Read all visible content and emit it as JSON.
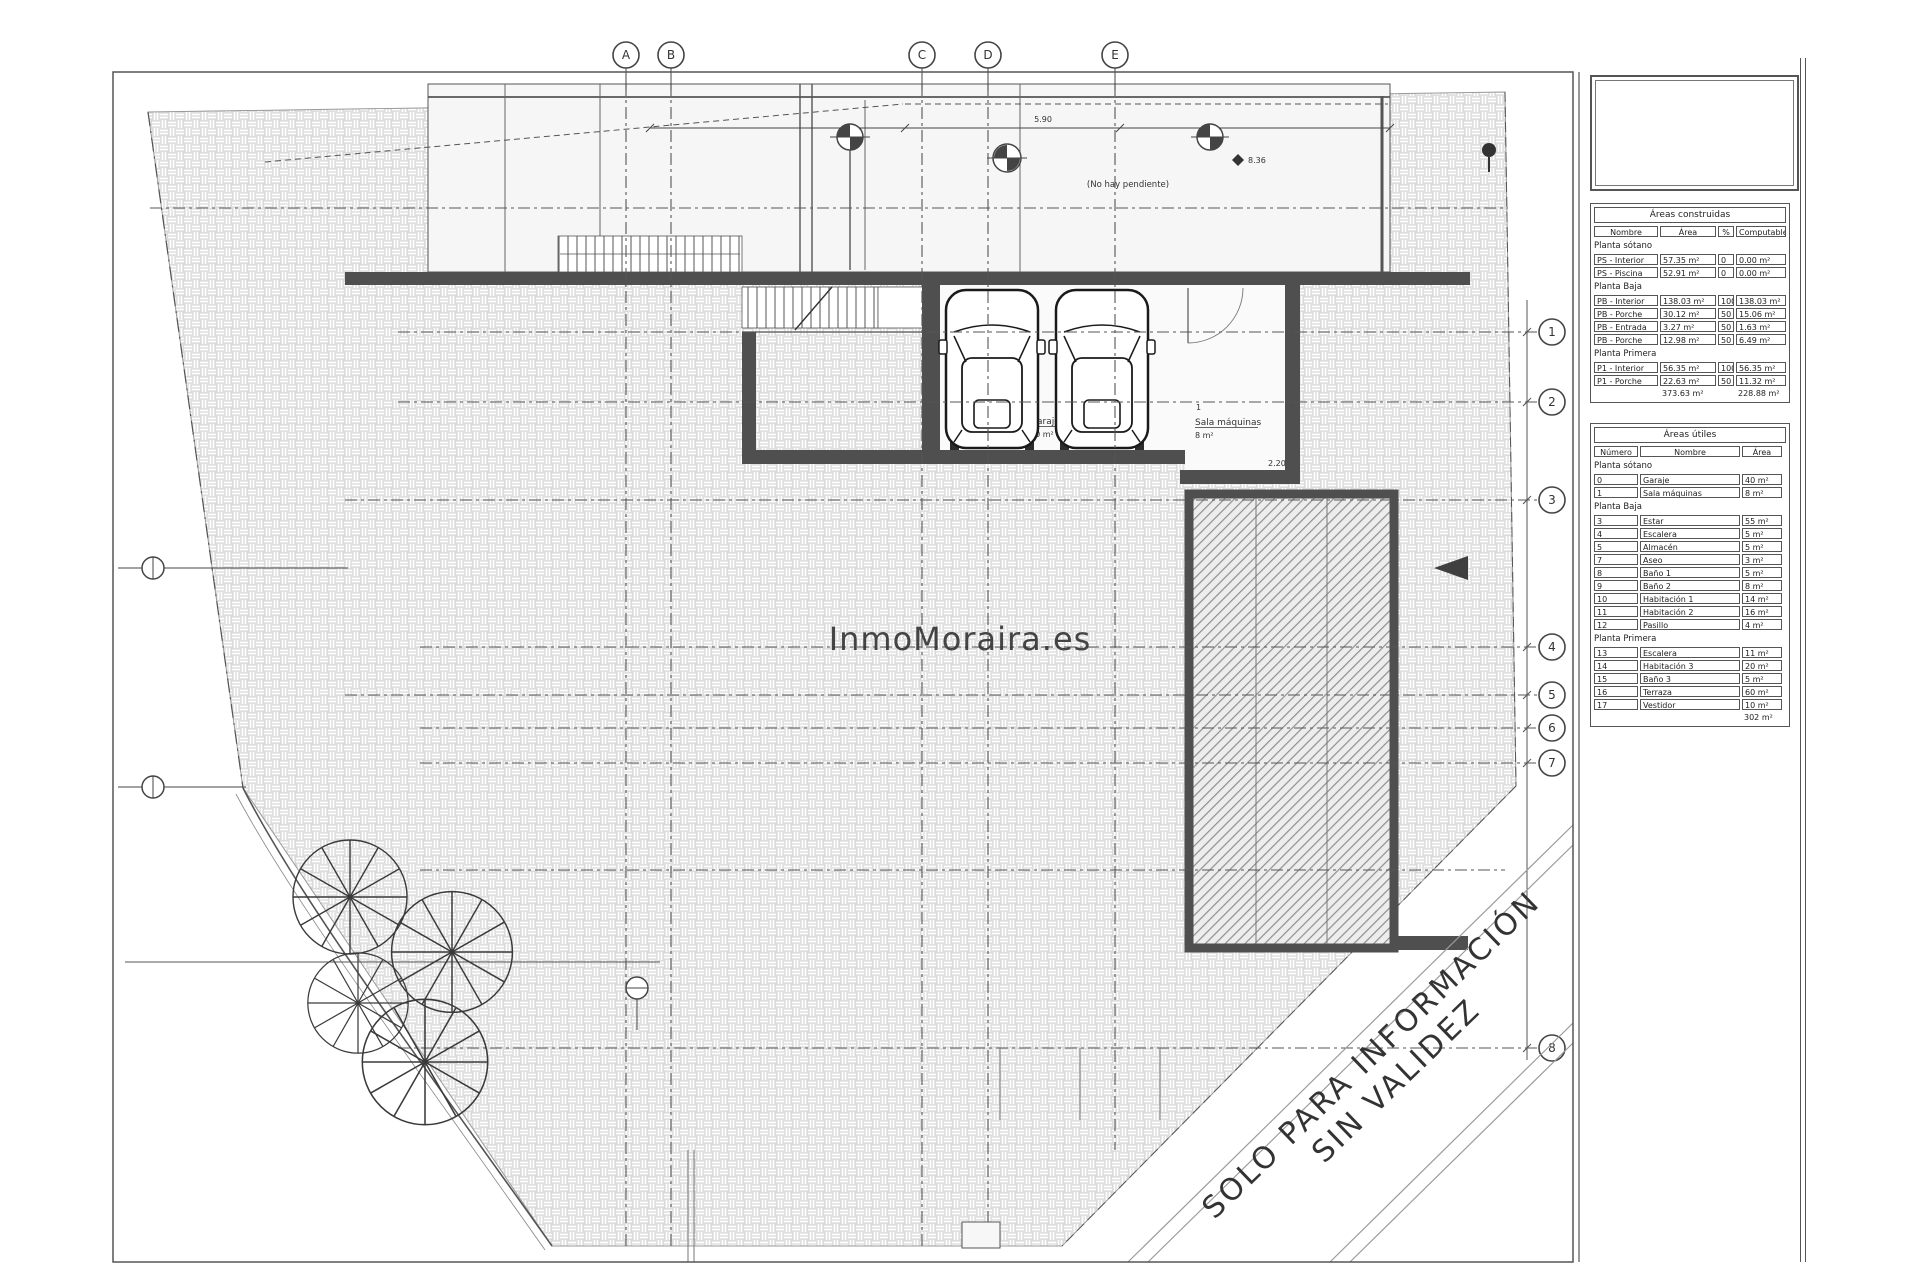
{
  "watermark": "InmoMoraira.es",
  "stamp": {
    "line1": "SOLO PARA INFORMACIÓN",
    "line2": "SIN VALIDEZ"
  },
  "grid": {
    "top": [
      "A",
      "B",
      "C",
      "D",
      "E"
    ],
    "right": [
      "1",
      "2",
      "3",
      "4",
      "5",
      "6",
      "7",
      "8"
    ]
  },
  "plan_labels": {
    "no_slope": "(No hay pendiente)",
    "garage_num": "0",
    "garage_name": "Garaje",
    "garage_area": "40 m²",
    "sala_num": "1",
    "sala_name": "Sala máquinas",
    "sala_area": "8 m²",
    "dim_a": "5.90",
    "dim_b": "8.36",
    "dim_c": "2.20"
  },
  "tables": {
    "areas_construidas": {
      "title": "Áreas construidas",
      "columns": [
        "Nombre",
        "Área",
        "%",
        "Computable"
      ],
      "sections": [
        {
          "label": "Planta sótano",
          "rows": [
            [
              "PS - Interior",
              "57.35 m²",
              "0",
              "0.00 m²"
            ],
            [
              "PS - Piscina",
              "52.91 m²",
              "0",
              "0.00 m²"
            ]
          ]
        },
        {
          "label": "Planta Baja",
          "rows": [
            [
              "PB - Interior",
              "138.03 m²",
              "100",
              "138.03 m²"
            ],
            [
              "PB - Porche",
              "30.12 m²",
              "50",
              "15.06 m²"
            ],
            [
              "PB - Entrada",
              "3.27 m²",
              "50",
              "1.63 m²"
            ],
            [
              "PB - Porche",
              "12.98 m²",
              "50",
              "6.49 m²"
            ]
          ]
        },
        {
          "label": "Planta Primera",
          "rows": [
            [
              "P1 - Interior",
              "56.35 m²",
              "100",
              "56.35 m²"
            ],
            [
              "P1 - Porche",
              "22.63 m²",
              "50",
              "11.32 m²"
            ]
          ]
        }
      ],
      "totals": [
        "",
        "373.63 m²",
        "",
        "228.88 m²"
      ]
    },
    "areas_utiles": {
      "title": "Áreas útiles",
      "columns": [
        "Número",
        "Nombre",
        "Área"
      ],
      "sections": [
        {
          "label": "Planta sótano",
          "rows": [
            [
              "0",
              "Garaje",
              "40 m²"
            ],
            [
              "1",
              "Sala máquinas",
              "8 m²"
            ]
          ]
        },
        {
          "label": "Planta Baja",
          "rows": [
            [
              "3",
              "Estar",
              "55 m²"
            ],
            [
              "4",
              "Escalera",
              "5 m²"
            ],
            [
              "5",
              "Almacén",
              "5 m²"
            ],
            [
              "7",
              "Aseo",
              "3 m²"
            ],
            [
              "8",
              "Baño 1",
              "5 m²"
            ],
            [
              "9",
              "Baño 2",
              "8 m²"
            ],
            [
              "10",
              "Habitación 1",
              "14 m²"
            ],
            [
              "11",
              "Habitación 2",
              "16 m²"
            ],
            [
              "12",
              "Pasillo",
              "4 m²"
            ]
          ]
        },
        {
          "label": "Planta Primera",
          "rows": [
            [
              "13",
              "Escalera",
              "11 m²"
            ],
            [
              "14",
              "Habitación 3",
              "20 m²"
            ],
            [
              "15",
              "Baño 3",
              "5 m²"
            ],
            [
              "16",
              "Terraza",
              "60 m²"
            ],
            [
              "17",
              "Vestidor",
              "10 m²"
            ]
          ]
        }
      ],
      "totals": [
        "",
        "",
        "302 m²"
      ]
    }
  }
}
